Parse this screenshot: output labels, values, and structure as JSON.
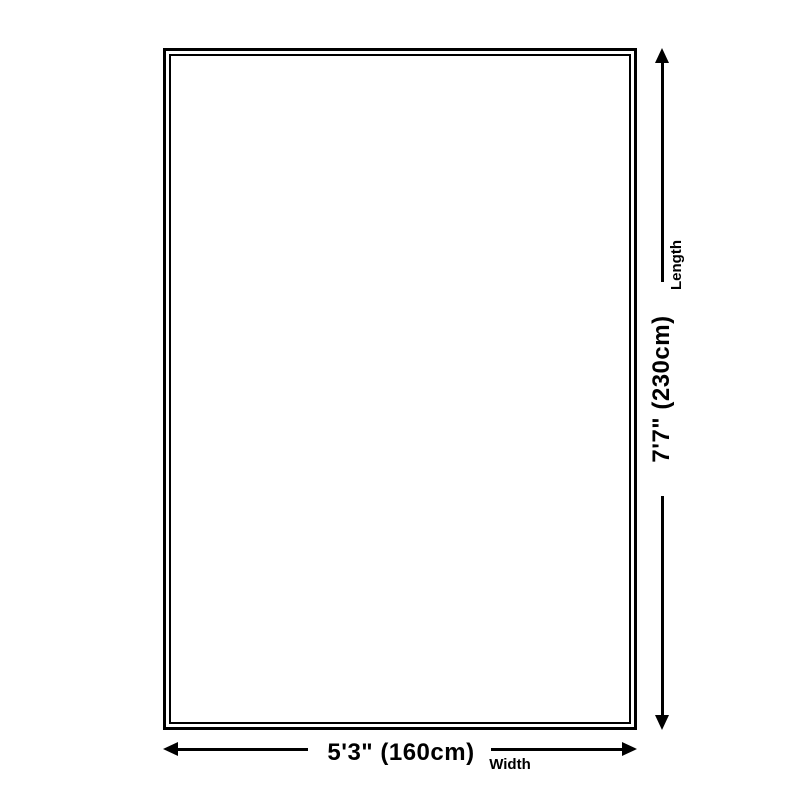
{
  "colors": {
    "background": "#ffffff",
    "line": "#000000",
    "text": "#000000"
  },
  "dimensions": {
    "width": {
      "value": "5'3\" (160cm)",
      "label": "Width"
    },
    "length": {
      "value": "7'7\" (230cm)",
      "label": "Length"
    }
  },
  "icons": [
    "arrow-left-icon",
    "arrow-right-icon",
    "arrow-up-icon",
    "arrow-down-icon"
  ]
}
